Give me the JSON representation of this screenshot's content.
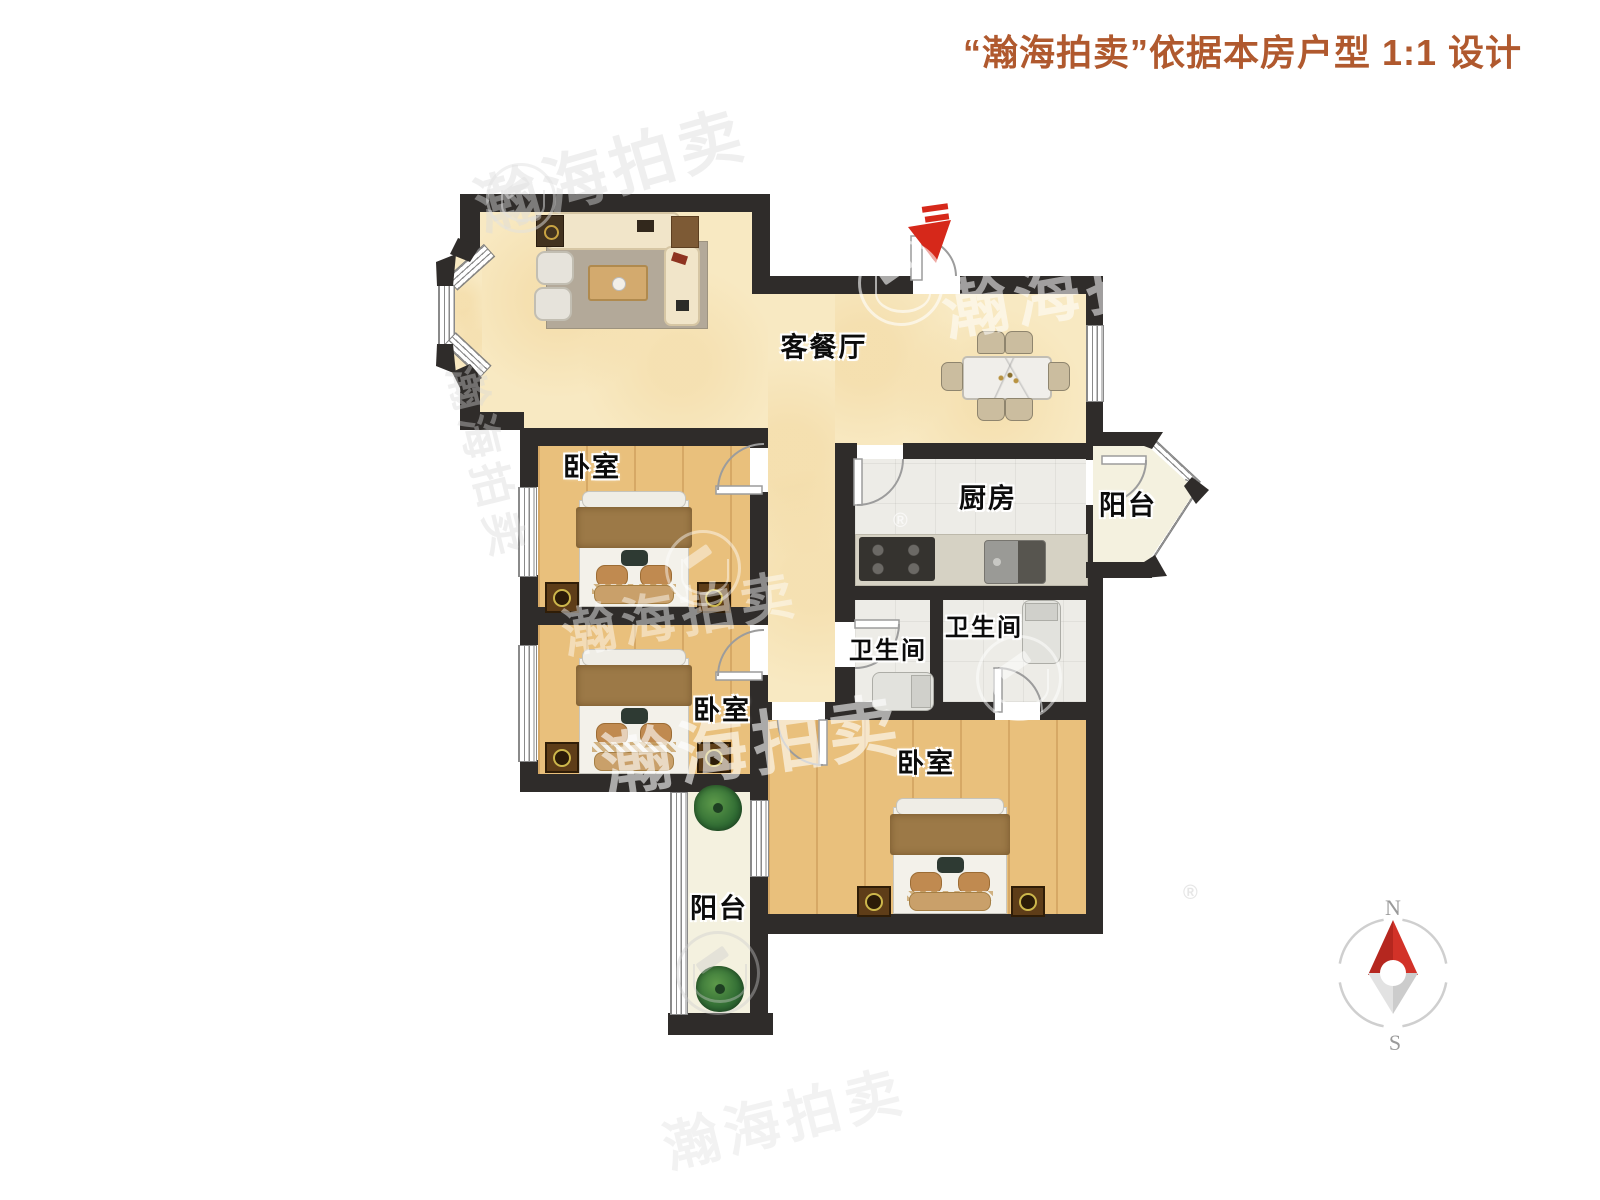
{
  "title": {
    "text": "“瀚海拍卖”依据本房户型 1:1 设计"
  },
  "rooms": {
    "living": {
      "label": "客餐厅"
    },
    "bedroom1": {
      "label": "卧室"
    },
    "bedroom2": {
      "label": "卧室"
    },
    "bedroom3": {
      "label": "卧室"
    },
    "kitchen": {
      "label": "厨房"
    },
    "bath1": {
      "label": "卫生间"
    },
    "bath2": {
      "label": "卫生间"
    },
    "balcony_right": {
      "label": "阳台"
    },
    "balcony_left": {
      "label": "阳台"
    }
  },
  "compass": {
    "north": "N",
    "south": "S"
  },
  "watermark": {
    "text": "瀚海拍卖",
    "reg": "®"
  },
  "colors": {
    "title_accent": "#b0592e",
    "wall": "#2f2c2a",
    "living_floor": "#f8e9c2",
    "wood_floor": "#e9c07c",
    "tile_floor": "#edece7",
    "balcony_floor": "#f4f1df",
    "entry_arrow": "#d6281a",
    "compass_north": "#c9302a"
  }
}
